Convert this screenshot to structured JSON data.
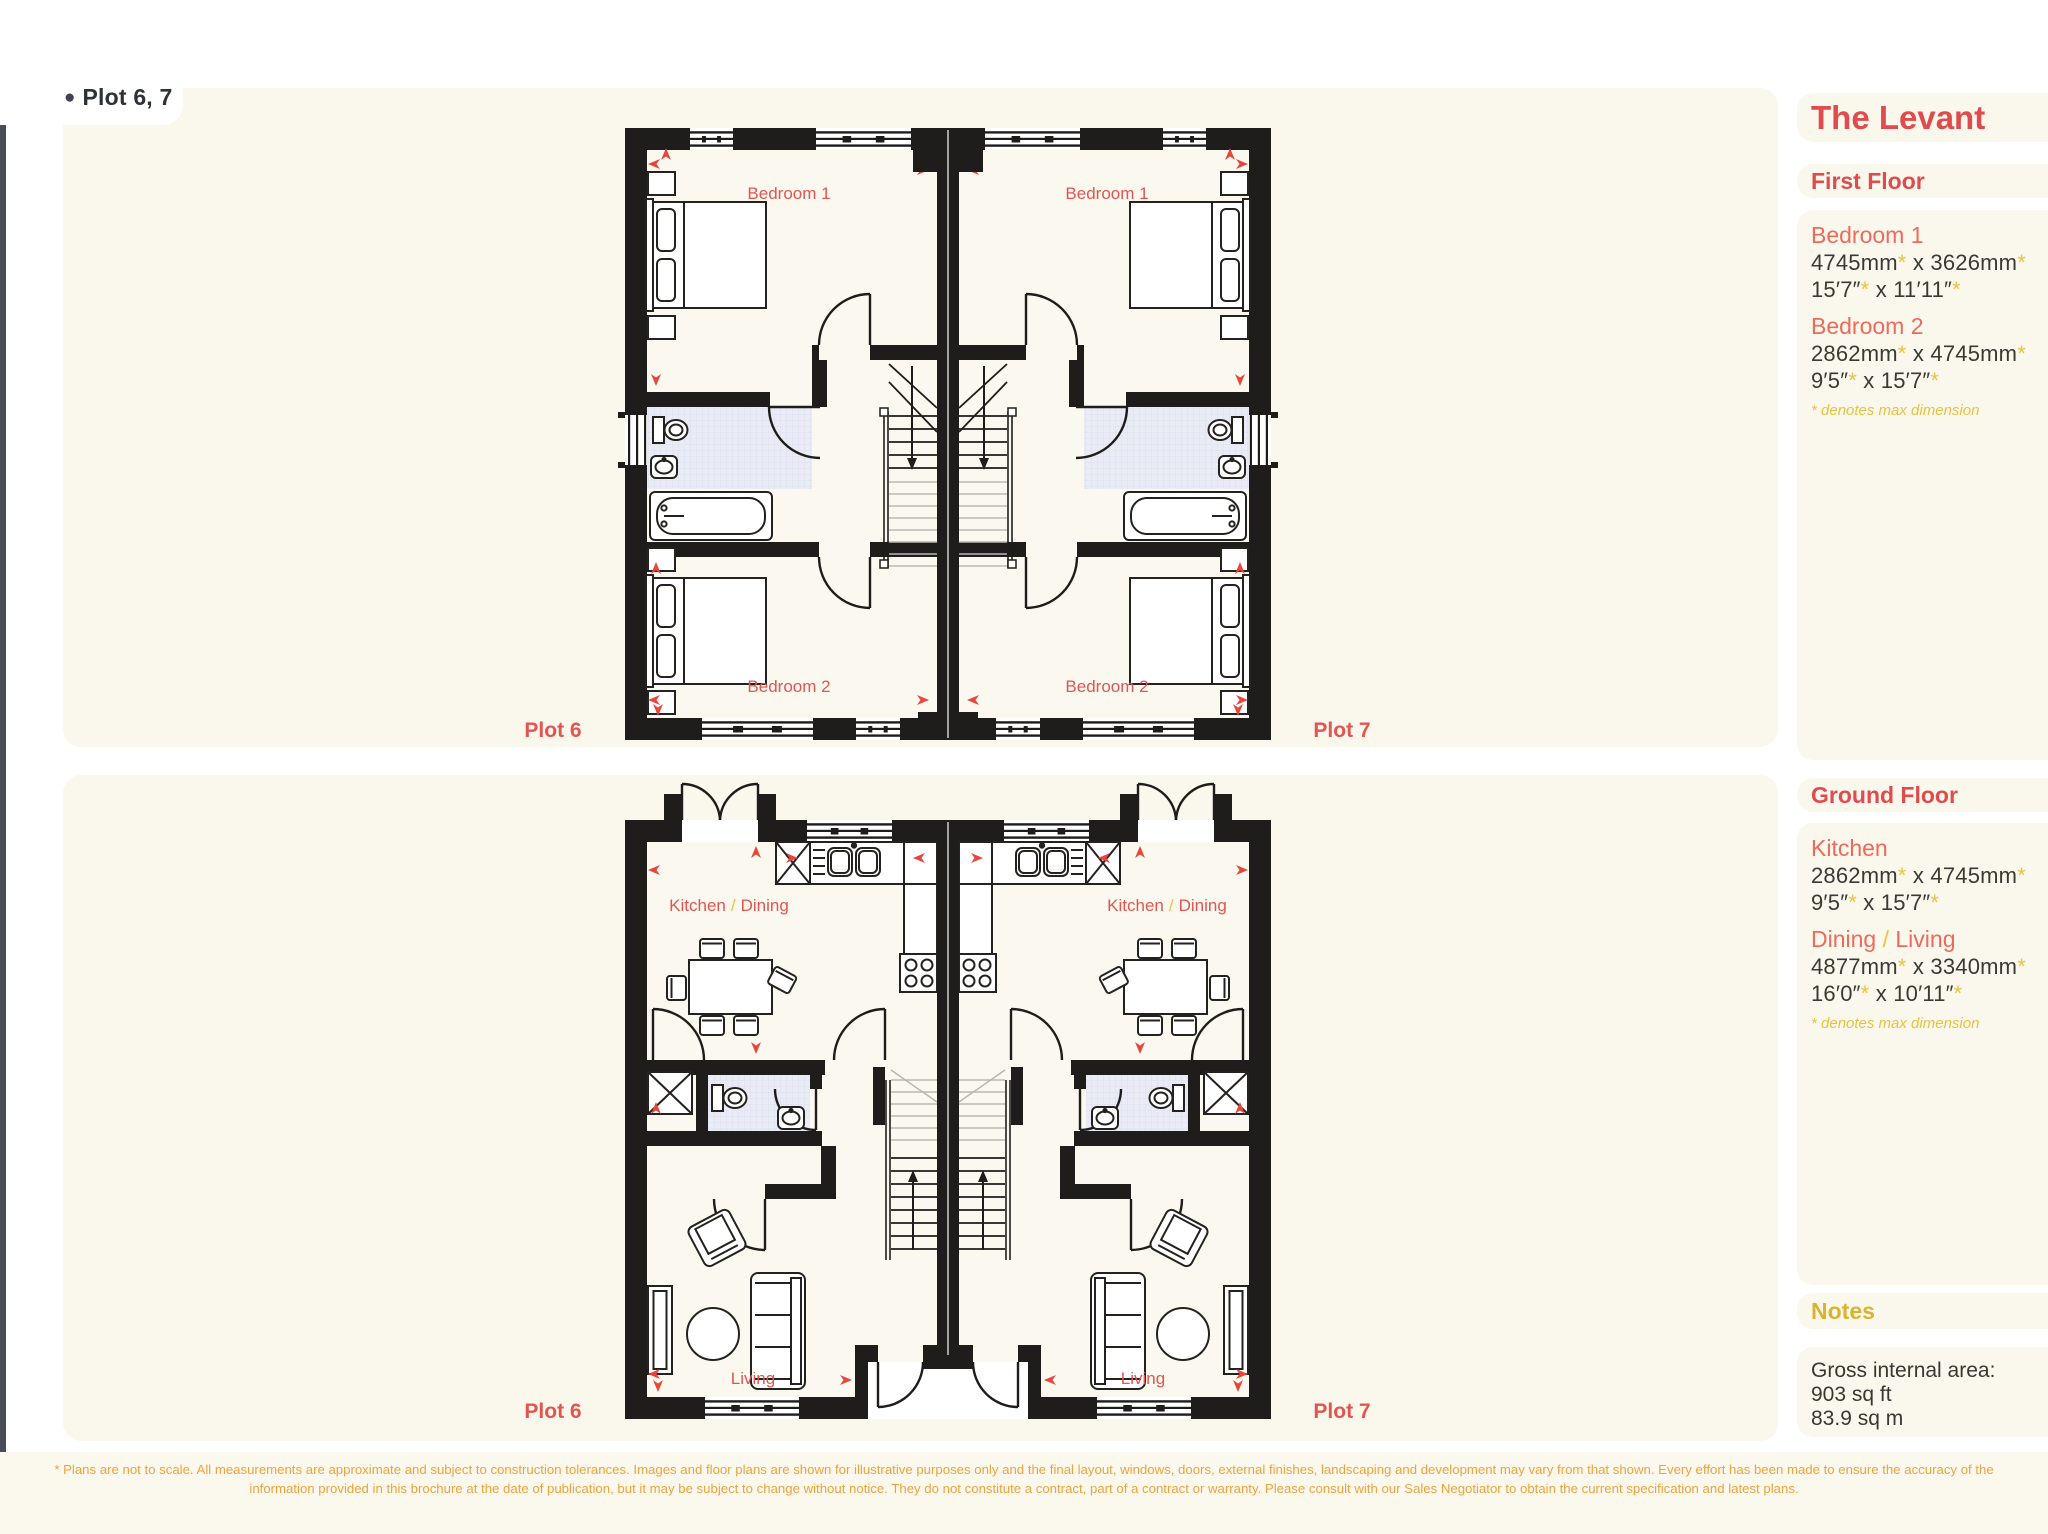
{
  "sym": {
    "bullet": "●",
    "star": "*",
    "x_sep": " x ",
    "slash": "/"
  },
  "page": {
    "plot_tag": "Plot 6, 7",
    "disclaimer_l1": "* Plans are not to scale. All measurements are approximate and subject to construction tolerances. Images and floor plans are shown for illustrative purposes only and the final layout, windows, doors, external finishes, landscaping and development may vary from that shown. Every effort has been made to ensure the accuracy of the",
    "disclaimer_l2": "information provided in this brochure at the date of publication, but it may be subject to change without notice. They do not constitute a contract, part of a contract or warranty. Please consult with our Sales Negotiator to obtain the current specification and latest plans."
  },
  "sidebar": {
    "title": "The Levant",
    "first_floor": {
      "heading": "First Floor",
      "rooms": [
        {
          "name": "Bedroom 1",
          "mm_a": "4745mm",
          "mm_b": "3626mm",
          "imp_a": "15′7″",
          "imp_b": "11′11″"
        },
        {
          "name": "Bedroom 2",
          "mm_a": "2862mm",
          "mm_b": "4745mm",
          "imp_a": "9′5″",
          "imp_b": "15′7″"
        }
      ],
      "footnote": "* denotes max dimension"
    },
    "ground_floor": {
      "heading": "Ground Floor",
      "rooms": [
        {
          "name": "Kitchen",
          "mm_a": "2862mm",
          "mm_b": "4745mm",
          "imp_a": "9′5″",
          "imp_b": "15′7″"
        },
        {
          "name_a": "Dining",
          "name_b": "Living",
          "mm_a": "4877mm",
          "mm_b": "3340mm",
          "imp_a": "16′0″",
          "imp_b": "10′11″"
        }
      ],
      "footnote": "* denotes max dimension"
    },
    "notes": {
      "heading": "Notes",
      "area_label": "Gross internal area:",
      "area_ft": "903 sq ft",
      "area_m": "83.9 sq m"
    }
  },
  "plans": {
    "first_floor": {
      "bedroom1": "Bedroom 1",
      "bedroom2": "Bedroom 2",
      "plot_left": "Plot 6",
      "plot_right": "Plot 7"
    },
    "ground_floor": {
      "kitchen": "Kitchen",
      "dining": "Dining",
      "living": "Living",
      "plot_left": "Plot 6",
      "plot_right": "Plot 7"
    }
  },
  "colors": {
    "accent_red": "#e04b4e",
    "room_coral": "#ee6a5c",
    "plan_label_red": "#e25551",
    "gold": "#e9c440",
    "notes_gold": "#dcb32e",
    "text_dark": "#3b3936",
    "disclaimer_orange": "#f0a23c",
    "wall": "#1e1d1b",
    "panel_cream": "#faf8ec",
    "bath_blue": "#e9ebf5",
    "tag_slate": "#3e4450"
  }
}
